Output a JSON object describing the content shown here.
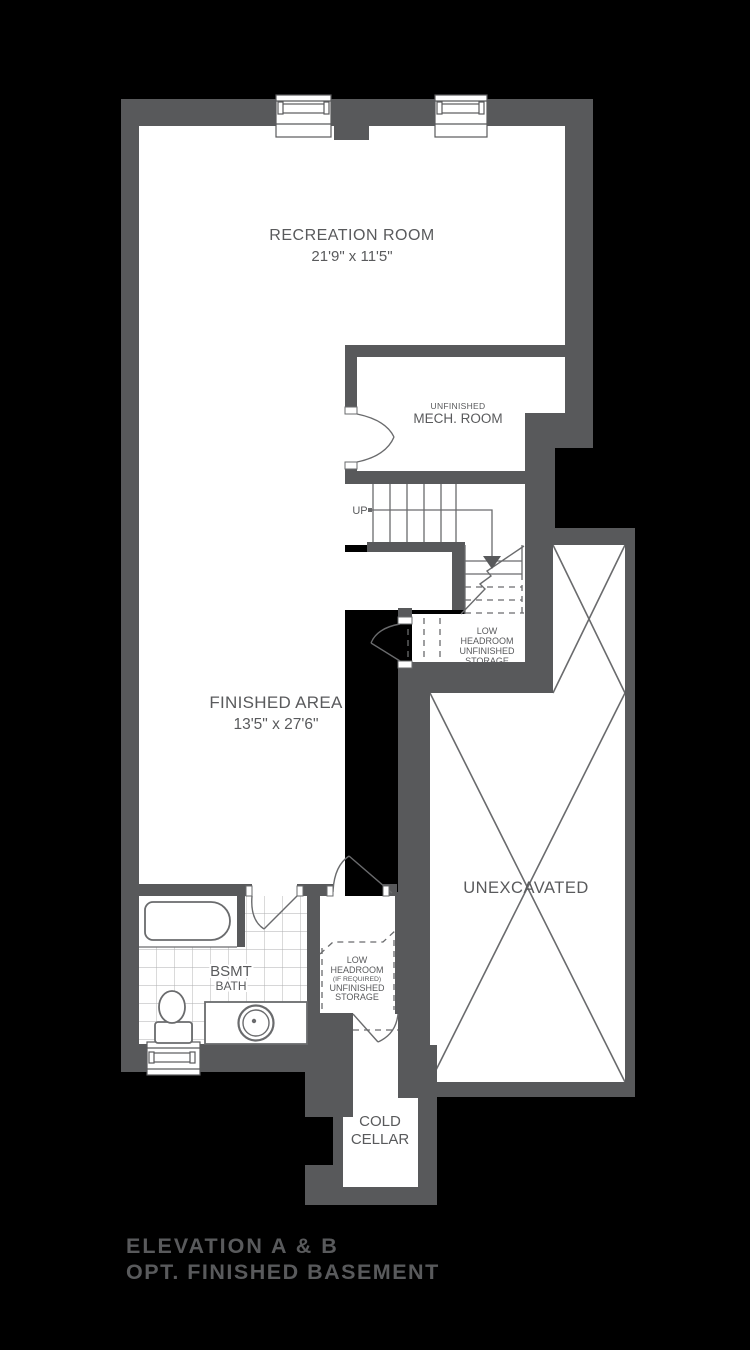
{
  "plan": {
    "type": "basement-floor-plan",
    "rooms": {
      "recreation": {
        "name": "RECREATION ROOM",
        "dims": "21'9\" x 11'5\""
      },
      "finished_area": {
        "name": "FINISHED AREA",
        "dims": "13'5\" x 27'6\""
      },
      "mech": {
        "line1": "UNFINISHED",
        "line2": "MECH. ROOM"
      },
      "storage_under_stairs": [
        "LOW",
        "HEADROOM",
        "UNFINISHED",
        "STORAGE"
      ],
      "storage_rear": [
        "LOW",
        "HEADROOM",
        "(IF REQUIRED)",
        "UNFINISHED",
        "STORAGE"
      ],
      "bath": {
        "line1": "BSMT",
        "line2": "BATH"
      },
      "cold_cellar": [
        "COLD",
        "CELLAR"
      ],
      "unexcavated": {
        "name": "UNEXCAVATED"
      },
      "stairs": {
        "direction": "UP"
      }
    },
    "title": {
      "line1": "ELEVATION A & B",
      "line2": "OPT. FINISHED BASEMENT"
    },
    "colors": {
      "background": "#000000",
      "wall": "#58595B",
      "room_fill": "#FFFFFF",
      "line": "#6A6B6D",
      "tile_line": "#ACADAF",
      "title_accent": "#A4905F",
      "title_dark": "#272522"
    }
  }
}
